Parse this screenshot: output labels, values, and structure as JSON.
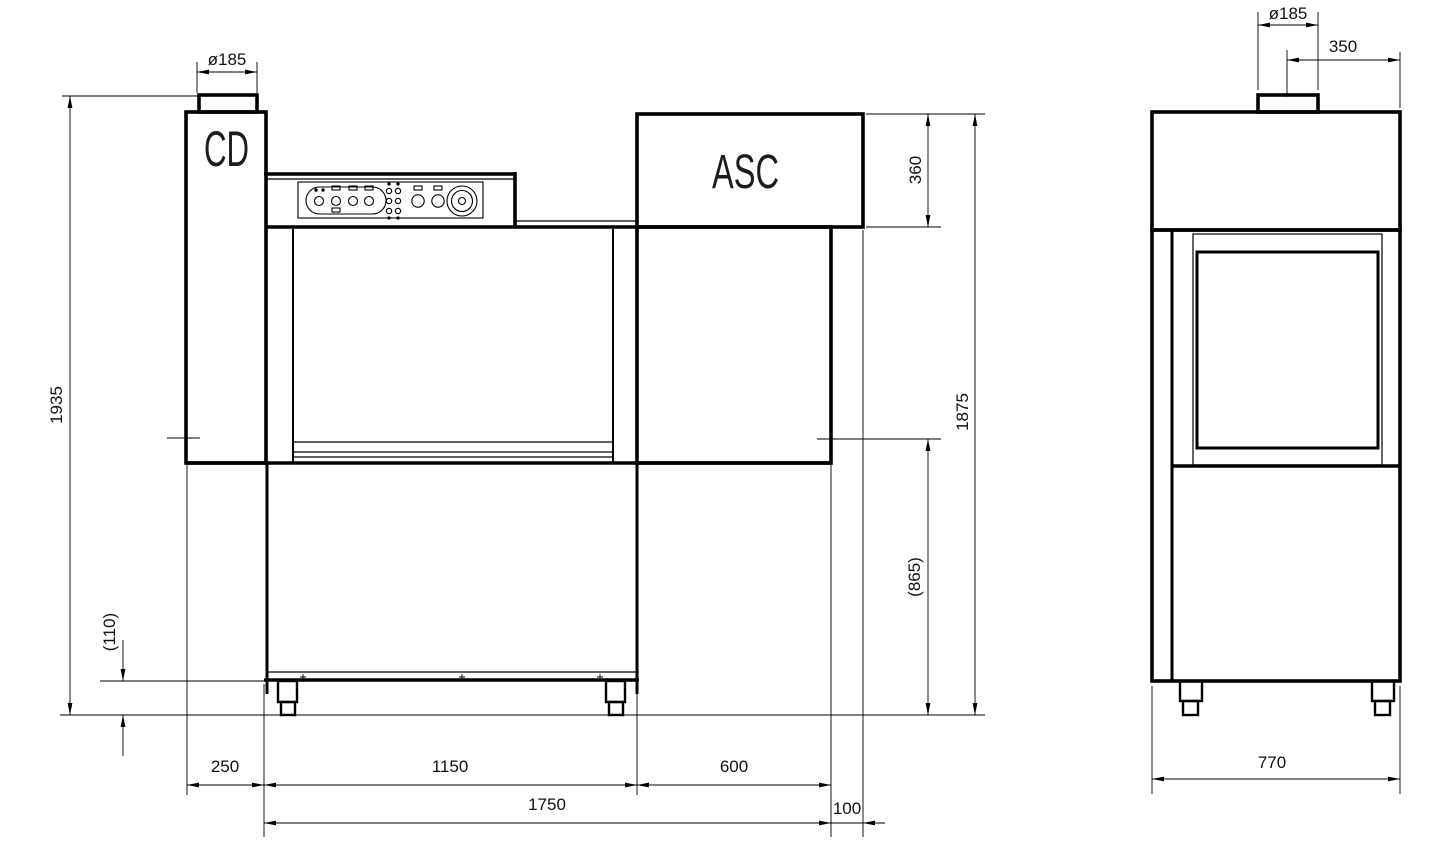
{
  "drawing": {
    "kind": "technical-dimension-drawing",
    "background": "#ffffff",
    "line_color": "#000000",
    "front_view": {
      "unit_label_left": "CD",
      "unit_label_right": "ASC",
      "dim_chimney_diameter": "ø185",
      "dim_overall_height": "1935",
      "dim_foot_height": "(110)",
      "dim_left_overhang": "250",
      "dim_wash_section_length": "1150",
      "dim_right_section_length": "600",
      "dim_overall_length": "1750",
      "dim_right_overhang": "100",
      "dim_asc_hood_height": "360",
      "dim_loading_height": "(865)",
      "dim_body_height": "1875"
    },
    "side_view": {
      "dim_chimney_diameter": "ø185",
      "dim_chimney_offset": "350",
      "dim_depth": "770"
    }
  }
}
